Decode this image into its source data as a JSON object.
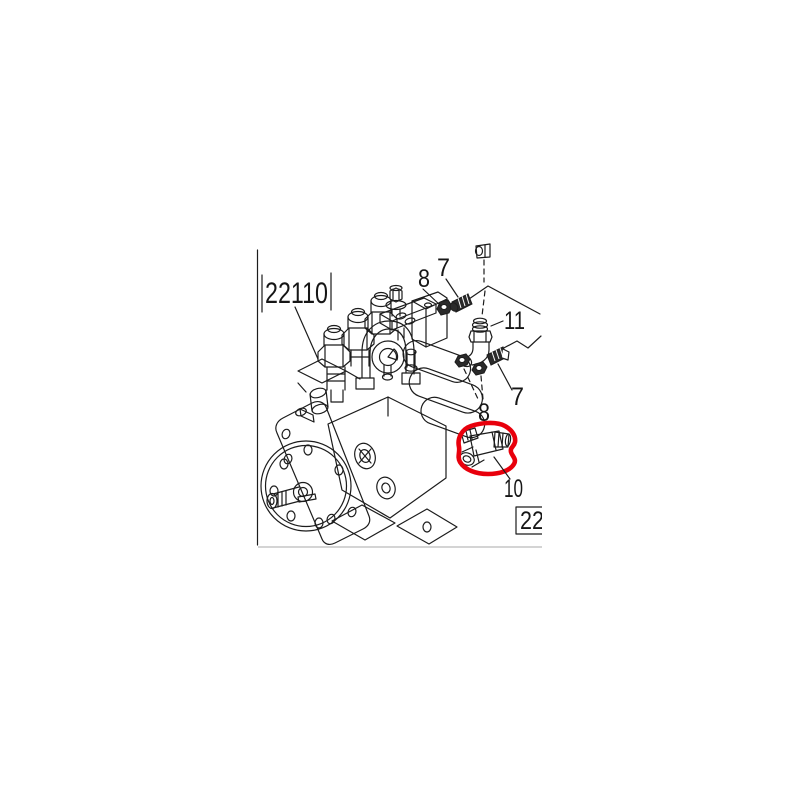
{
  "diagram": {
    "figure_label": "22110",
    "ref_box_label": "22",
    "callouts": [
      {
        "ref": "8",
        "position": "top"
      },
      {
        "ref": "7",
        "position": "top"
      },
      {
        "ref": "11",
        "position": "right-of-elbow"
      },
      {
        "ref": "7",
        "position": "lower-right"
      },
      {
        "ref": "8",
        "position": "middle"
      },
      {
        "ref": "10",
        "position": "bottom-right"
      }
    ],
    "highlight": {
      "part_ref": "10",
      "color": "#e8000c",
      "shape": "hand-drawn-ellipse"
    },
    "colors": {
      "line": "#1c1c1c",
      "background": "#ffffff",
      "bottom_edge": "#c6c6c6"
    }
  }
}
